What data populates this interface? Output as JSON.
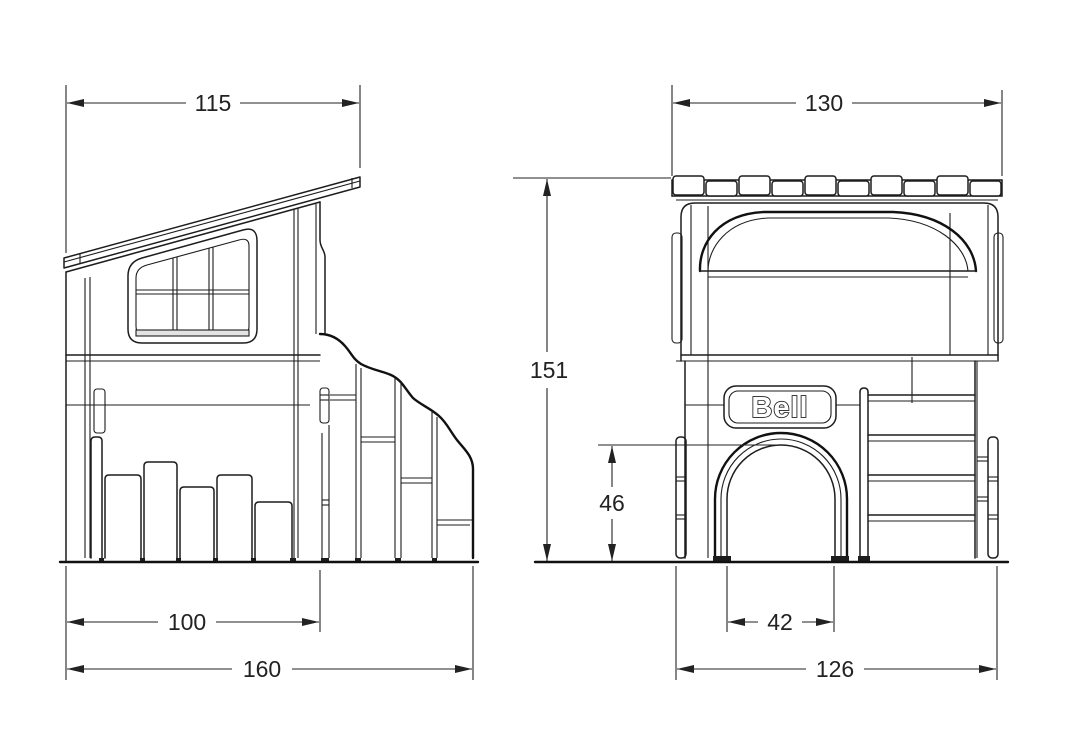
{
  "drawing": {
    "product_name": "Bell",
    "type": "technical-drawing",
    "side_view": {
      "dim_roof_width": "115",
      "dim_body_width": "100",
      "dim_overall_width": "160"
    },
    "front_view": {
      "dim_roof_width": "130",
      "dim_overall_height": "151",
      "dim_door_height": "46",
      "dim_door_width": "42",
      "dim_overall_width": "126"
    }
  },
  "colors": {
    "line": "#1d1d1d",
    "background": "#ffffff",
    "dimension": "#222222"
  }
}
